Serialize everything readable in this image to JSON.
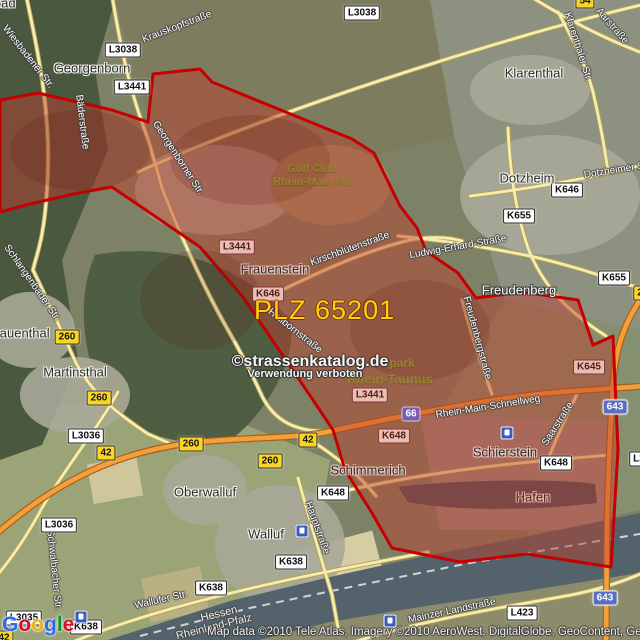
{
  "map": {
    "plz_label": "PLZ 65201",
    "watermark": {
      "line1": "©strassenkatalog.de",
      "line2": "Verwendung verboten"
    },
    "attribution": {
      "google": "Google",
      "credits": "Map data ©2010 Tele Atlas, Imagery ©2010 AeroWest, DigitalGlobe, GeoContent, GeoEye"
    },
    "colors": {
      "overlay_fill": "#ba3e2e",
      "overlay_border": "#c40000",
      "plz_text": "#f6d60a",
      "water": "#53626b",
      "road_major": "#f2a03c",
      "road_minor": "#f6edaf",
      "shield_yellow": "#fbd524",
      "shield_blue": "#5a6fc4",
      "forest": "#4a5840"
    },
    "places": [
      {
        "name": "Schlangenbad",
        "x": -26,
        "y": 3,
        "style": ""
      },
      {
        "name": "Georgenborn",
        "x": 92,
        "y": 68,
        "style": ""
      },
      {
        "name": "Klarenthal",
        "x": 534,
        "y": 73,
        "style": ""
      },
      {
        "name": "Dotzheim",
        "x": 527,
        "y": 178,
        "style": ""
      },
      {
        "name": "Frauenstein",
        "x": 275,
        "y": 269,
        "style": "redtint"
      },
      {
        "name": "Freudenberg",
        "x": 519,
        "y": 290,
        "style": "light"
      },
      {
        "name": "Rauenthal",
        "x": 20,
        "y": 333,
        "style": ""
      },
      {
        "name": "Martinsthal",
        "x": 75,
        "y": 372,
        "style": ""
      },
      {
        "name": "Oberwalluf",
        "x": 205,
        "y": 492,
        "style": ""
      },
      {
        "name": "Walluf",
        "x": 266,
        "y": 534,
        "style": ""
      },
      {
        "name": "Schimmerich",
        "x": 368,
        "y": 470,
        "style": "redtint"
      },
      {
        "name": "Schierstein",
        "x": 505,
        "y": 452,
        "style": "redtint"
      },
      {
        "name": "Hafen",
        "x": 533,
        "y": 497,
        "style": "maroon"
      }
    ],
    "streets": [
      {
        "name": "Krauskopfstraße",
        "x": 177,
        "y": 27,
        "rot": -21
      },
      {
        "name": "Wiesbadener Str.",
        "x": 28,
        "y": 57,
        "rot": 52
      },
      {
        "name": "Bäderstraße",
        "x": 82,
        "y": 122,
        "rot": 83
      },
      {
        "name": "Aarstraße",
        "x": 612,
        "y": 26,
        "rot": 49
      },
      {
        "name": "Klarenthaler Str.",
        "x": 578,
        "y": 47,
        "rot": 72
      },
      {
        "name": "Dotzheimer Str.",
        "x": 618,
        "y": 170,
        "rot": -9
      },
      {
        "name": "Georgenborner Str.",
        "x": 178,
        "y": 158,
        "rot": 57
      },
      {
        "name": "Kirschblütenstraße",
        "x": 350,
        "y": 249,
        "rot": -20
      },
      {
        "name": "Ludwig-Erhard-Straße",
        "x": 458,
        "y": 247,
        "rot": -10
      },
      {
        "name": "Hollbornstraße",
        "x": 295,
        "y": 331,
        "rot": 38
      },
      {
        "name": "Freudenbergstraße",
        "x": 477,
        "y": 338,
        "rot": 75
      },
      {
        "name": "Rhein-Main-Schnellweg",
        "x": 488,
        "y": 407,
        "rot": -9
      },
      {
        "name": "Saarstraße",
        "x": 558,
        "y": 424,
        "rot": -57
      },
      {
        "name": "Hauptstraße",
        "x": 317,
        "y": 528,
        "rot": 70
      },
      {
        "name": "Wallufer Str.",
        "x": 161,
        "y": 600,
        "rot": -13
      },
      {
        "name": "Mainzer Landstraße",
        "x": 452,
        "y": 611,
        "rot": -12
      },
      {
        "name": "Schwalbacher Str.",
        "x": 54,
        "y": 570,
        "rot": 84
      },
      {
        "name": "Schlangenbader Str.",
        "x": 32,
        "y": 283,
        "rot": 55
      }
    ],
    "areas": [
      {
        "name": "Golf Club",
        "x": 312,
        "y": 169,
        "size": 11
      },
      {
        "name": "Rhein-Main eV.",
        "x": 312,
        "y": 182,
        "size": 11
      },
      {
        "name": "park",
        "x": 402,
        "y": 363,
        "size": 12
      },
      {
        "name": "Rhein-Taunus",
        "x": 390,
        "y": 379,
        "size": 13
      }
    ],
    "state_labels": [
      {
        "name": "Hessen",
        "x": 219,
        "y": 614,
        "rot": -14
      },
      {
        "name": "Rheinland-Pfalz",
        "x": 214,
        "y": 627,
        "rot": -14
      }
    ],
    "shields": [
      {
        "label": "L3038",
        "x": 123,
        "y": 50,
        "variant": "white"
      },
      {
        "label": "L3038",
        "x": 362,
        "y": 13,
        "variant": "white"
      },
      {
        "label": "L3441",
        "x": 132,
        "y": 87,
        "variant": "white"
      },
      {
        "label": "L3441",
        "x": 237,
        "y": 247,
        "variant": "pink"
      },
      {
        "label": "L3441",
        "x": 370,
        "y": 395,
        "variant": "pink"
      },
      {
        "label": "K646",
        "x": 268,
        "y": 294,
        "variant": "pink"
      },
      {
        "label": "K646",
        "x": 567,
        "y": 190,
        "variant": "white"
      },
      {
        "label": "K655",
        "x": 519,
        "y": 216,
        "variant": "white"
      },
      {
        "label": "K655",
        "x": 614,
        "y": 278,
        "variant": "white"
      },
      {
        "label": "K645",
        "x": 589,
        "y": 367,
        "variant": "pink"
      },
      {
        "label": "K648",
        "x": 394,
        "y": 436,
        "variant": "pink"
      },
      {
        "label": "K648",
        "x": 333,
        "y": 493,
        "variant": "white"
      },
      {
        "label": "K648",
        "x": 556,
        "y": 463,
        "variant": "white"
      },
      {
        "label": "K638",
        "x": 291,
        "y": 562,
        "variant": "white"
      },
      {
        "label": "K638",
        "x": 211,
        "y": 588,
        "variant": "white"
      },
      {
        "label": "K638",
        "x": 86,
        "y": 627,
        "variant": "white"
      },
      {
        "label": "L3036",
        "x": 86,
        "y": 436,
        "variant": "white"
      },
      {
        "label": "L3036",
        "x": 59,
        "y": 525,
        "variant": "white"
      },
      {
        "label": "L3035",
        "x": 24,
        "y": 618,
        "variant": "white"
      },
      {
        "label": "L423",
        "x": 522,
        "y": 613,
        "variant": "white"
      },
      {
        "label": "260",
        "x": 67,
        "y": 337,
        "variant": "yellow"
      },
      {
        "label": "260",
        "x": 99,
        "y": 398,
        "variant": "yellow"
      },
      {
        "label": "260",
        "x": 191,
        "y": 444,
        "variant": "yellow"
      },
      {
        "label": "260",
        "x": 270,
        "y": 461,
        "variant": "yellow"
      },
      {
        "label": "42",
        "x": 106,
        "y": 453,
        "variant": "yellow"
      },
      {
        "label": "42",
        "x": 308,
        "y": 440,
        "variant": "yellow"
      },
      {
        "label": "42",
        "x": 4,
        "y": 638,
        "variant": "yellow"
      },
      {
        "label": "54",
        "x": 585,
        "y": 1,
        "variant": "yellow"
      },
      {
        "label": "2",
        "x": 640,
        "y": 293,
        "variant": "yellow"
      },
      {
        "label": "L3",
        "x": 639,
        "y": 459,
        "variant": "white"
      },
      {
        "label": "66",
        "x": 411,
        "y": 414,
        "variant": "purple"
      },
      {
        "label": "643",
        "x": 615,
        "y": 407,
        "variant": "blue"
      },
      {
        "label": "643",
        "x": 605,
        "y": 598,
        "variant": "blue"
      }
    ],
    "station_icons": [
      {
        "x": 81,
        "y": 617
      },
      {
        "x": 302,
        "y": 531
      },
      {
        "x": 390,
        "y": 621
      },
      {
        "x": 507,
        "y": 433
      }
    ]
  }
}
